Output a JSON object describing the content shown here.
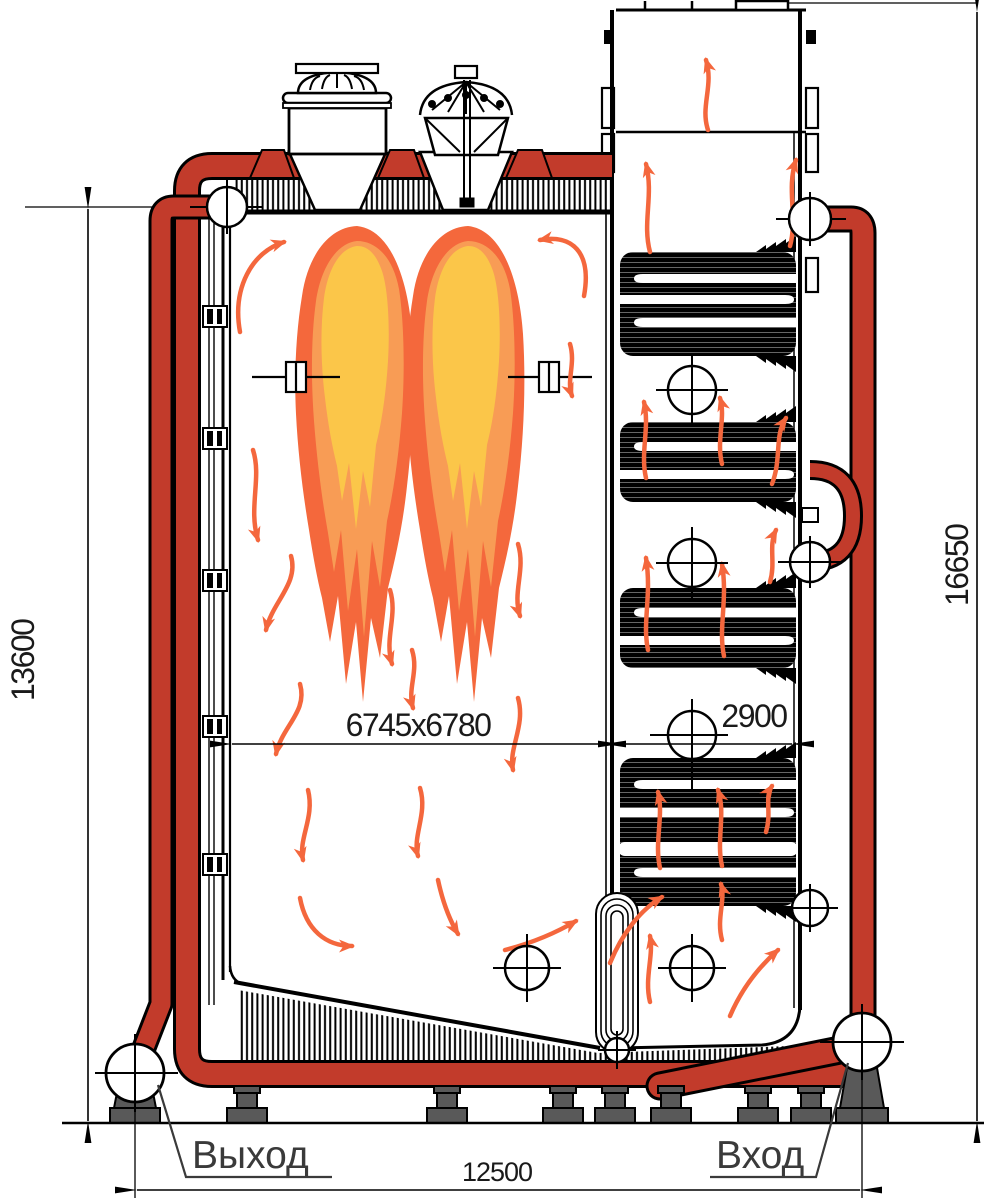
{
  "drawing": {
    "type": "industrial water boiler cross-section, side view",
    "dimensions": {
      "height_left": "13600",
      "height_right": "16650",
      "furnace_width": "6745x6780",
      "convective_width": "2900",
      "base_width": "12500"
    },
    "labels": {
      "outlet": "Выход",
      "inlet": "Вход"
    },
    "colors": {
      "pipe_red": "#C23B2B",
      "flame_outer": "#F4683C",
      "flame_mid": "#F89C55",
      "flame_core": "#FBC649",
      "arrow_orange": "#F4673D",
      "foot_gray": "#595959",
      "line_black": "#000000"
    }
  }
}
